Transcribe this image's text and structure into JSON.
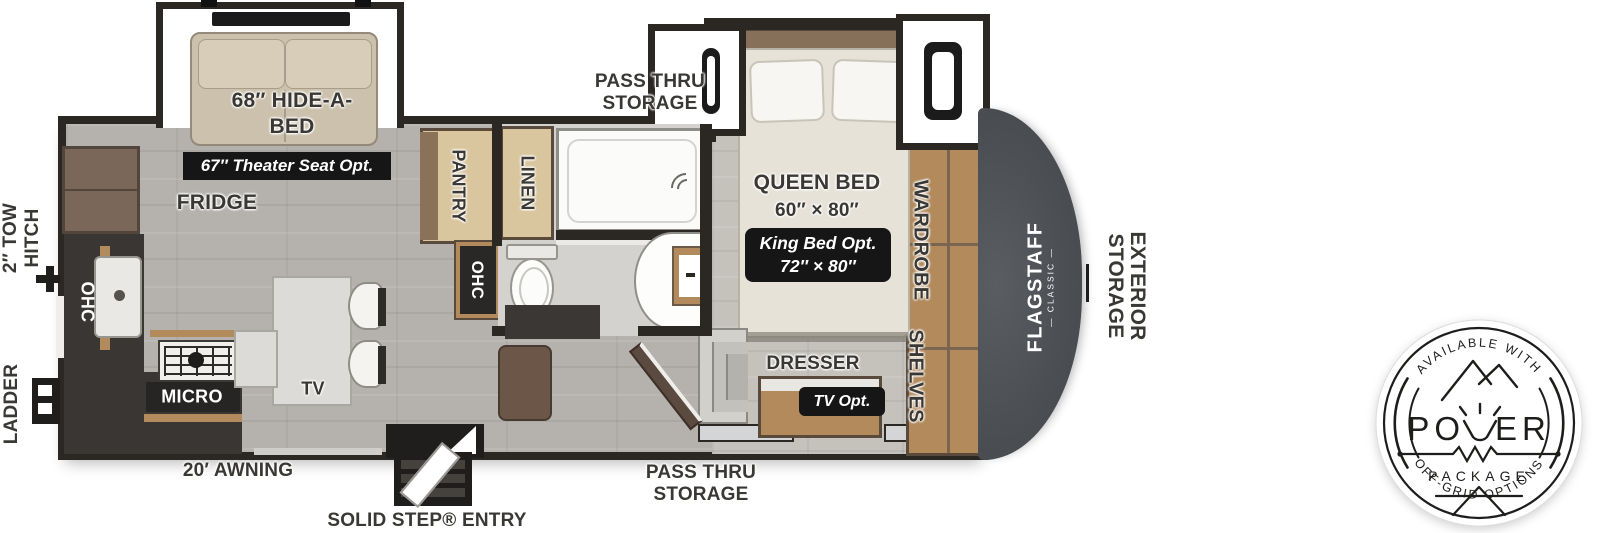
{
  "palette": {
    "wall": "#2b2823",
    "floor": "#b5b2ad",
    "bedroom_floor": "#c5c2bc",
    "wood": "#b28a5c",
    "counter": "#393633",
    "banner": "#161616",
    "cap": "#4c4f54",
    "sofa": "#cbc1ac",
    "bed": "#e6e2d8"
  },
  "exterior": {
    "tow_hitch_line1": "2″ TOW",
    "tow_hitch_line2": "HITCH",
    "ladder": "LADDER",
    "awning": "20′ AWNING",
    "entry": "SOLID STEP® ENTRY",
    "pass_thru_top_line1": "PASS THRU",
    "pass_thru_top_line2": "STORAGE",
    "pass_thru_bottom_line1": "PASS THRU",
    "pass_thru_bottom_line2": "STORAGE",
    "exterior_storage_line1": "EXTERIOR",
    "exterior_storage_line2": "STORAGE"
  },
  "living": {
    "hide_a_bed_line1": "68″ HIDE-A-",
    "hide_a_bed_line2": "BED",
    "theater_opt": "67″ Theater Seat Opt.",
    "fridge": "FRIDGE",
    "ohc": "OHC",
    "micro": "MICRO",
    "tv": "TV"
  },
  "bath": {
    "pantry": "PANTRY",
    "ohc": "OHC",
    "linen": "LINEN"
  },
  "bedroom": {
    "queen": "QUEEN BED",
    "queen_size": "60″ × 80″",
    "king_line1": "King Bed Opt.",
    "king_line2": "72″ × 80″",
    "wardrobe": "WARDROBE",
    "shelves": "SHELVES",
    "dresser": "DRESSER",
    "tv_opt": "TV Opt."
  },
  "brand": {
    "name": "FLAGSTAFF",
    "series": "— CLASSIC —"
  },
  "badge": {
    "top": "AVAILABLE WITH",
    "power_left": "PO",
    "power_right": "ER",
    "package": "PACKAGE",
    "bottom": "OFF-GRID OPTIONS"
  }
}
